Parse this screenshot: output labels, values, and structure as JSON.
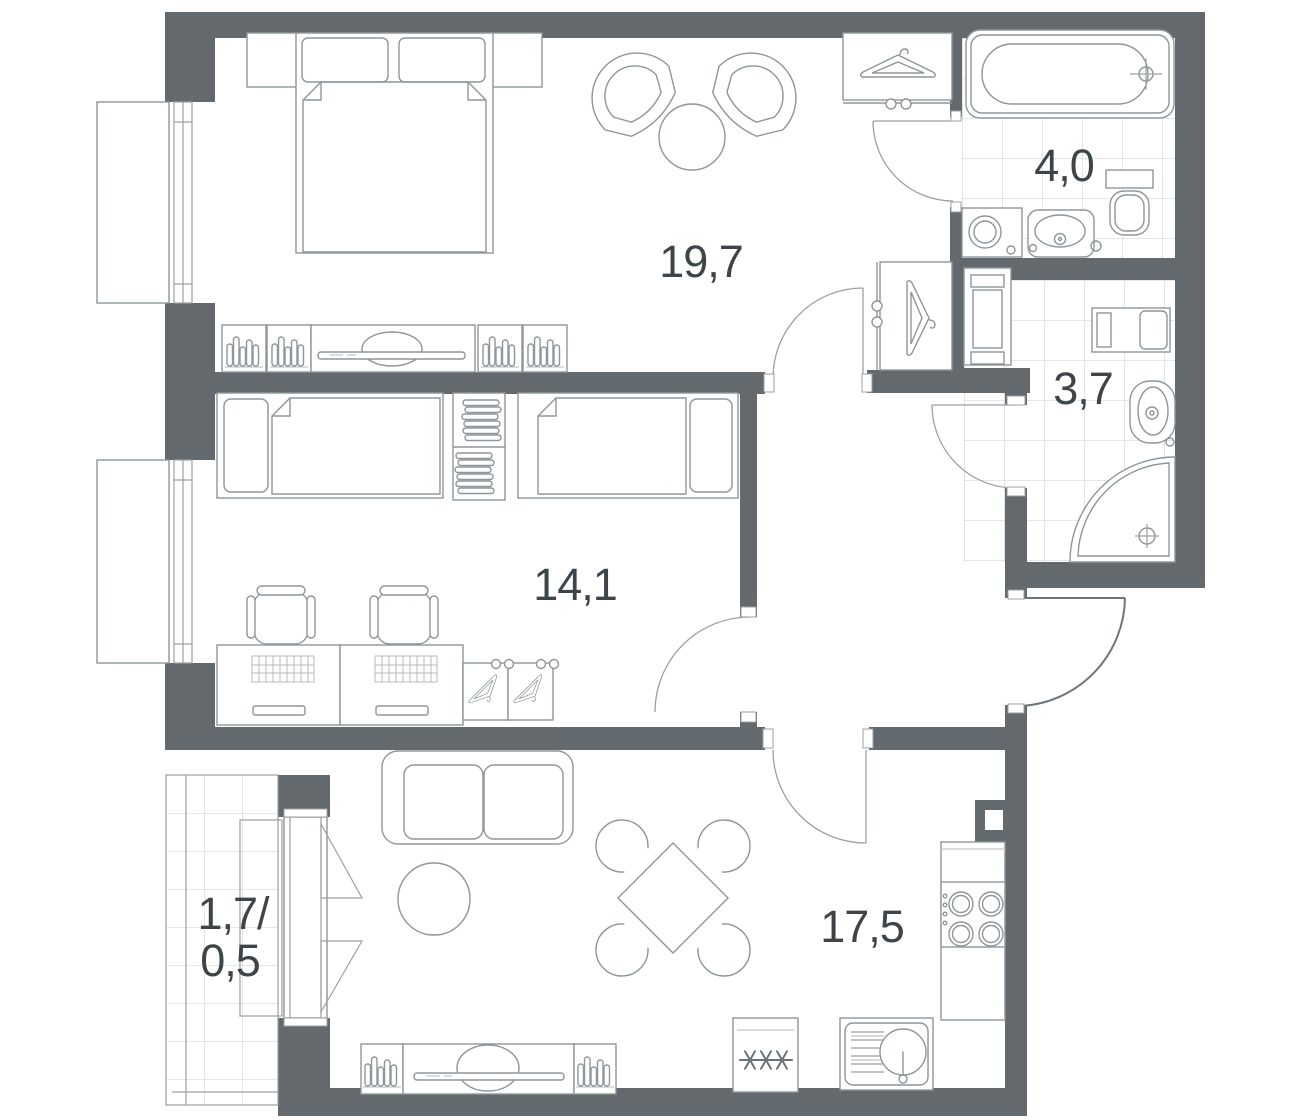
{
  "title": "apartment-floor-plan",
  "colors": {
    "wall": "#63696c",
    "furniture_line": "#8d969a",
    "tile_line": "#c9ced1",
    "label_text": "#3d4549",
    "background": "#ffffff"
  },
  "rooms": {
    "bedroom": {
      "name": "bedroom",
      "area": "19,7"
    },
    "bathroom": {
      "name": "bathroom",
      "area": "4,0"
    },
    "shower_room": {
      "name": "shower-room",
      "area": "3,7"
    },
    "children_room": {
      "name": "children-room",
      "area": "14,1"
    },
    "living_kitchen": {
      "name": "living-kitchen",
      "area": "17,5"
    },
    "balcony": {
      "name": "balcony",
      "area_line1": "1,7/",
      "area_line2": "0,5"
    }
  },
  "icons": [
    "double-bed",
    "pillow",
    "nightstand",
    "tv-stand",
    "books",
    "armchair",
    "side-table",
    "wardrobe",
    "hanger",
    "closet",
    "bathtub",
    "faucet",
    "washing-machine",
    "sink",
    "toilet",
    "towel-cabinet",
    "shower-tray",
    "single-bed",
    "shelf-clothes",
    "desk",
    "office-chair",
    "sofa",
    "coffee-table",
    "dining-table",
    "dining-chair",
    "stove",
    "refrigerator",
    "kitchen-sink",
    "window",
    "balcony-door",
    "door-swing",
    "vent-shaft"
  ]
}
